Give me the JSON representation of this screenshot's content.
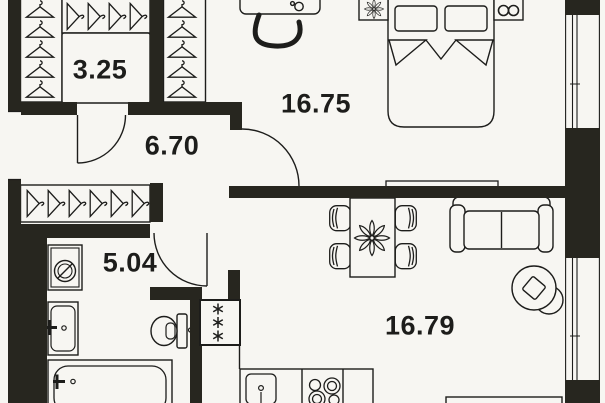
{
  "plan": {
    "title": "apartment-floor-plan",
    "rooms": [
      {
        "id": "closet",
        "area": "3.25"
      },
      {
        "id": "hallway",
        "area": "6.70"
      },
      {
        "id": "bedroom",
        "area": "16.75"
      },
      {
        "id": "bathroom",
        "area": "5.04"
      },
      {
        "id": "living-kitchen",
        "area": "16.79"
      }
    ],
    "colors": {
      "background": "#f7f6f2",
      "wall": "#27261f",
      "line": "#1d1d1b"
    },
    "furniture": [
      "wardrobe-hangers-closet",
      "overhead-hangers-closet",
      "bedroom-wardrobe-hangers",
      "coat-rack",
      "desk",
      "desk-chair",
      "double-bed",
      "pillows",
      "nightstand-left-flower",
      "nightstand-right-eyeglasses",
      "tv",
      "dining-table",
      "dining-chairs",
      "table-flower",
      "sofa",
      "round-armchair",
      "ventilation-shaft",
      "washing-machine",
      "bathroom-sink",
      "toilet",
      "bathtub",
      "kitchen-sink",
      "stove",
      "kitchen-counter",
      "island-counter"
    ],
    "windows": [
      "right-wall-upper-window",
      "right-wall-lower-window",
      "entrance-opening-left"
    ]
  }
}
